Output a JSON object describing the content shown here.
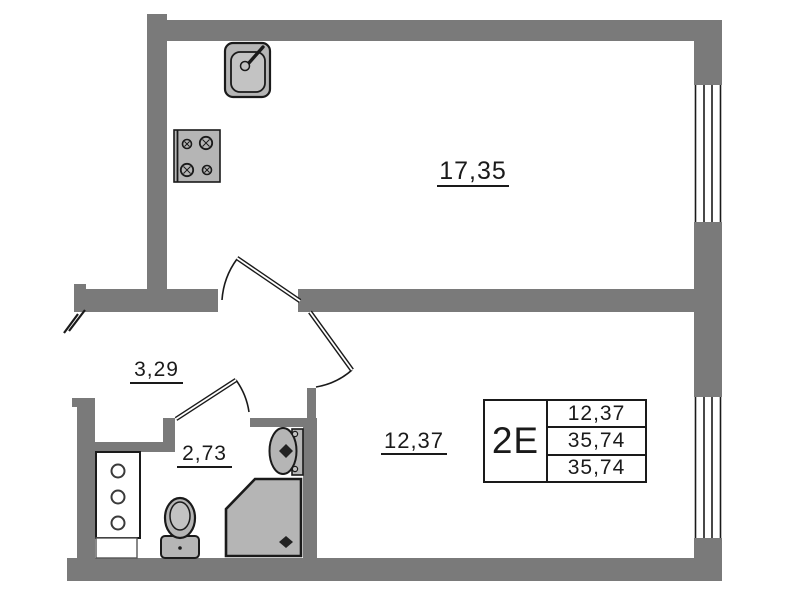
{
  "plan": {
    "title": "apartment-floor-plan",
    "info_box": {
      "unit": "2E",
      "rows": [
        "12,37",
        "35,74",
        "35,74"
      ]
    },
    "rooms": {
      "living_kitchen": {
        "area": "17,35"
      },
      "bedroom": {
        "area": "12,37"
      },
      "hallway": {
        "area": "3,29"
      },
      "bathroom": {
        "area": "2,73"
      }
    },
    "fixtures": [
      "kitchen-sink-icon",
      "stove-icon",
      "wardrobe-icon",
      "toilet-icon",
      "washbasin-icon",
      "shower-icon"
    ],
    "windows": [
      "window-right-top",
      "window-right-bottom"
    ],
    "doors": [
      "entrance-door-mark",
      "door-living",
      "door-bedroom",
      "door-bathroom"
    ],
    "colors": {
      "wall": "#7a7a7a",
      "fixture": "#b5b5b5",
      "fixture_light": "#c3c3c3",
      "line": "#1a1a1a",
      "background": "#ffffff"
    }
  }
}
